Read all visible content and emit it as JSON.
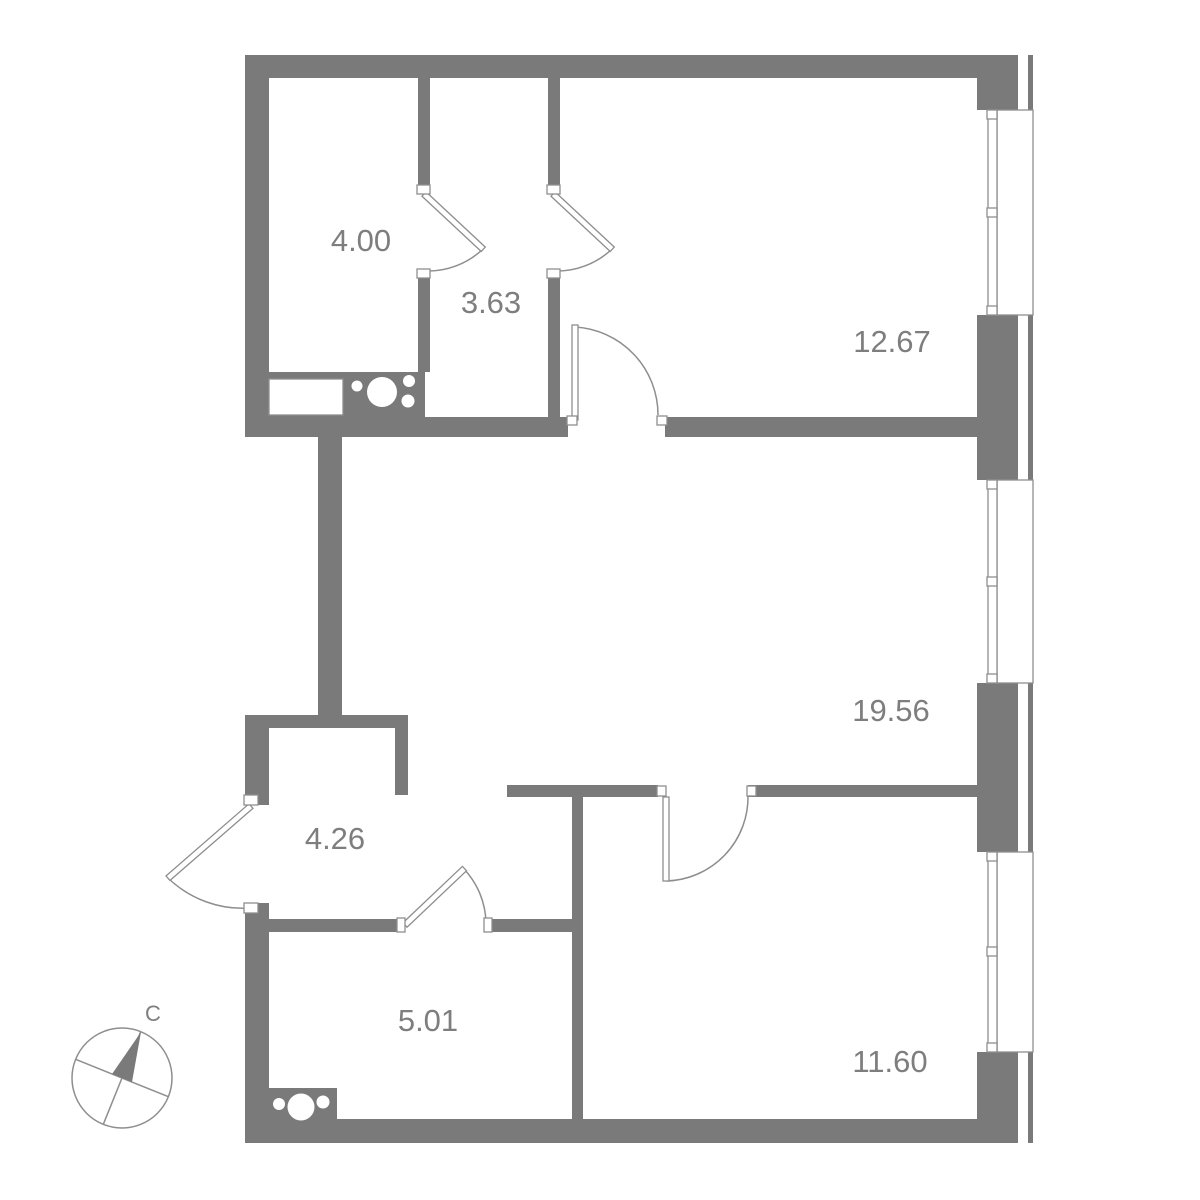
{
  "plan": {
    "rooms": [
      {
        "name": "room-top-left",
        "area": "4.00"
      },
      {
        "name": "room-top-middle",
        "area": "3.63"
      },
      {
        "name": "room-top-right",
        "area": "12.67"
      },
      {
        "name": "room-living",
        "area": "19.56"
      },
      {
        "name": "room-hallway",
        "area": "4.26"
      },
      {
        "name": "room-bathroom",
        "area": "5.01"
      },
      {
        "name": "room-bottom-right",
        "area": "11.60"
      }
    ],
    "compass": {
      "north_label": "С"
    },
    "colors": {
      "wall": "#7a7a7a",
      "line": "#8e8e8e",
      "text": "#7e7e7e",
      "background": "#ffffff"
    }
  }
}
